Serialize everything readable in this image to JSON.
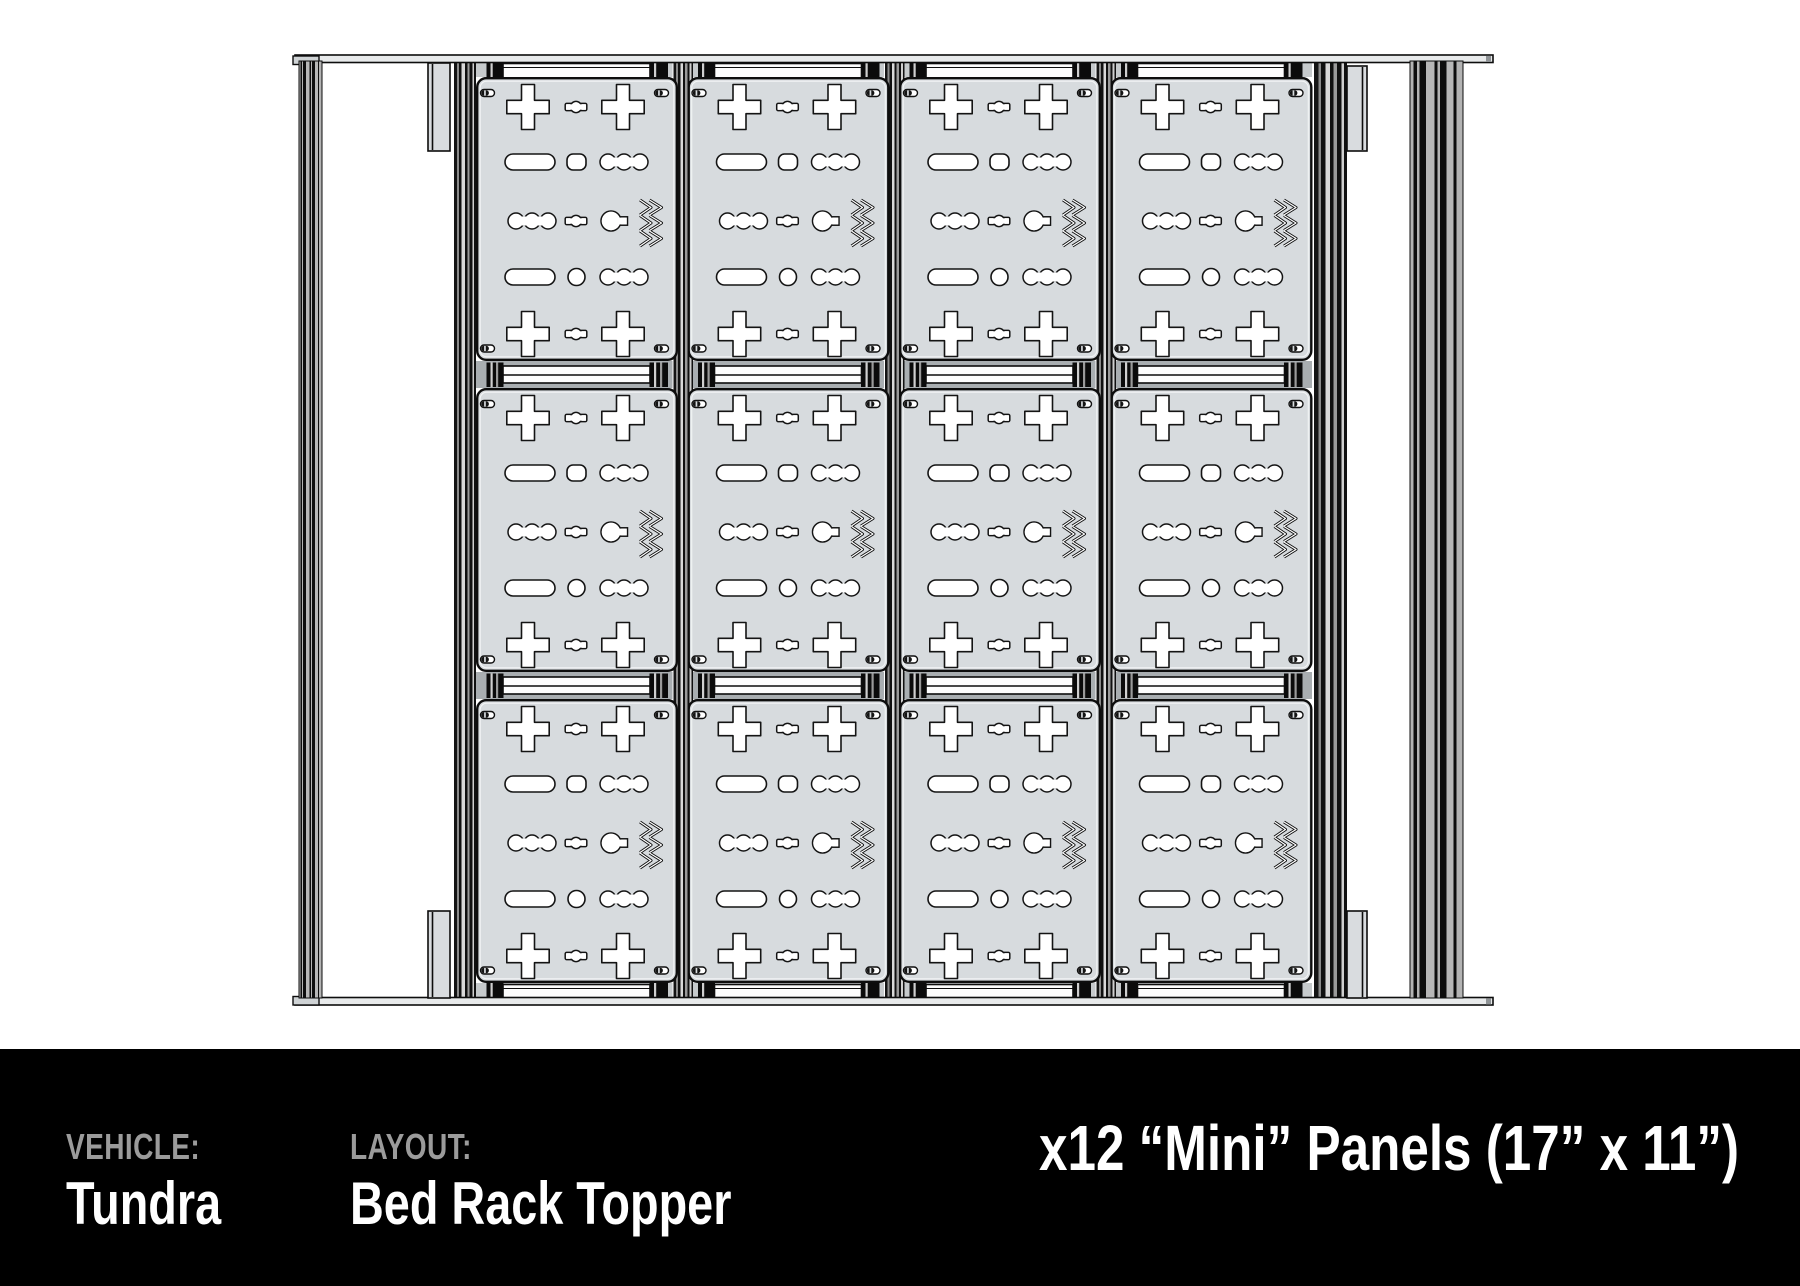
{
  "title": "Bed Rack Topper Layout Diagram",
  "footer": {
    "vehicle_label": "VEHICLE:",
    "vehicle_value": "Tundra",
    "layout_label": "LAYOUT:",
    "layout_value": "Bed Rack Topper",
    "panels_title": "x12 “Mini” Panels (17” x 11”)"
  },
  "diagram": {
    "grid": {
      "columns": 4,
      "rows": 3,
      "panel_total": 12
    },
    "panel": {
      "name": "Mini",
      "size": "17\" x 11\""
    },
    "colors": {
      "panel_fill": "#d7dbde",
      "line": "#0d0d0d",
      "channel_gray": "#a9aeb1",
      "margin_gray": "#c6cacc",
      "footer_bg": "#000000",
      "label_gray": "#9b9b9b"
    }
  }
}
